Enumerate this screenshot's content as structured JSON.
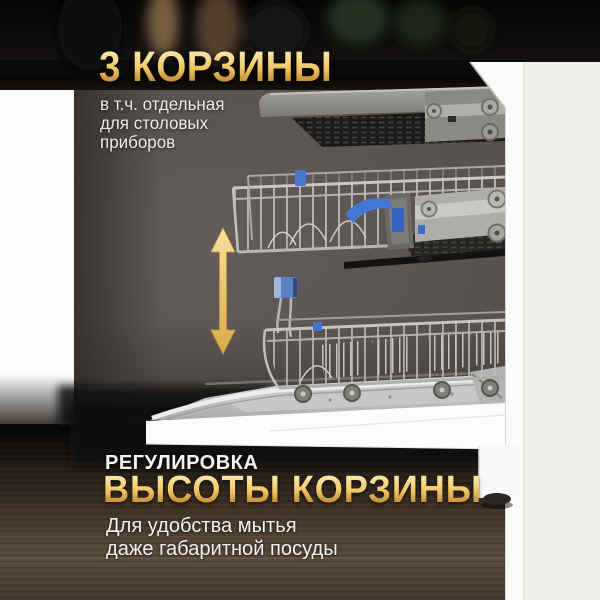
{
  "banner": {
    "header": {
      "title": "3 КОРЗИНЫ",
      "subtitle_lines": [
        "в т.ч. отдельная",
        "для столовых",
        "приборов"
      ]
    },
    "footer": {
      "eyebrow": "РЕГУЛИРОВКА",
      "title": "ВЫСОТЫ КОРЗИНЫ",
      "description_lines": [
        "Для удобства мытья",
        "даже габаритной посуды"
      ]
    }
  },
  "icons": {
    "height_arrow": "up-down-arrow-icon"
  },
  "colors": {
    "gold_light": "#fbe7a9",
    "gold_dark": "#c6923a",
    "arrow_gold": "#e9c266",
    "text_white": "#f0efed",
    "accent_blue": "#4a77cc",
    "interior_backdrop": "#57524f",
    "kitchen_dark": "#0a0908",
    "wall_offwhite": "#f1efec",
    "panel_white": "#fbfbfa",
    "floor_wood": "#4a3c2f"
  }
}
